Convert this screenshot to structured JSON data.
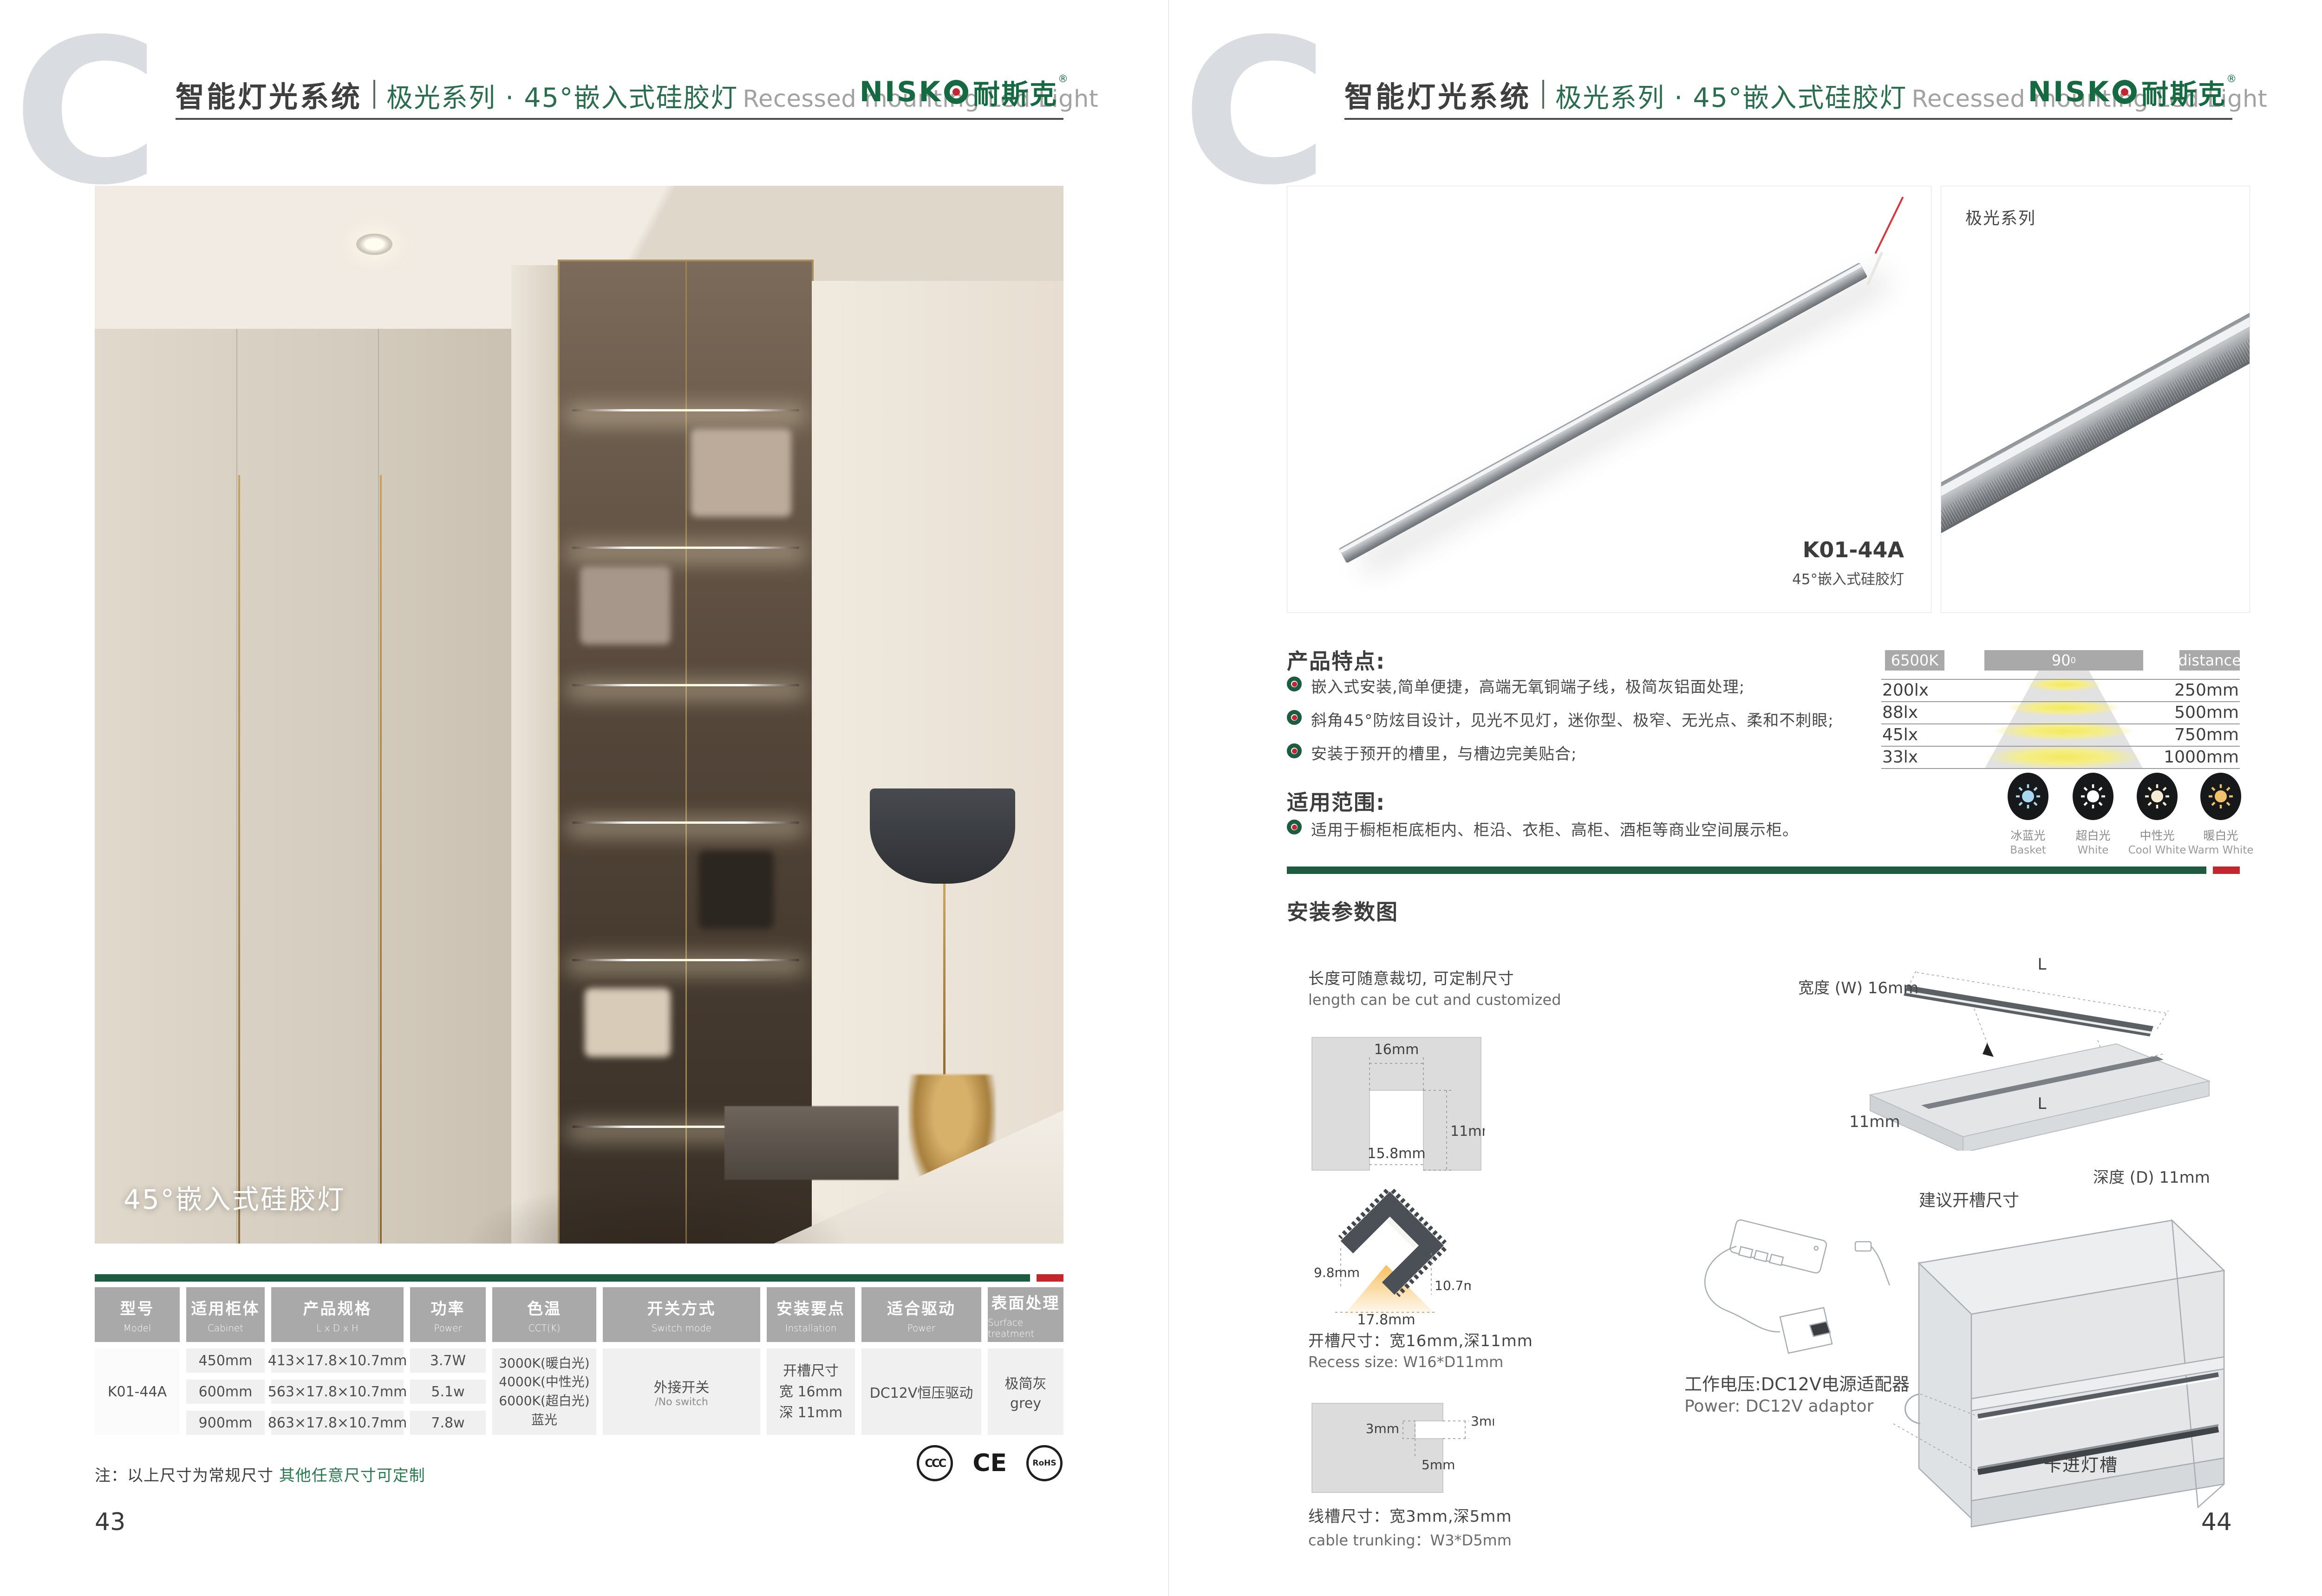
{
  "header": {
    "system": "智能灯光系统",
    "series": "极光系列 · 45°嵌入式硅胶灯",
    "subtitle_en": "Recessed mounting Led Light",
    "logo": {
      "latin": "NISK",
      "cn": "耐斯克",
      "reg": "®"
    }
  },
  "colors": {
    "green": "#1d5c40",
    "red": "#c1272d",
    "table_header_gray": "#a9a9a9"
  },
  "left_page": {
    "photo_caption": "45°嵌入式硅胶灯",
    "spec_table": {
      "headers": [
        {
          "zh": "型号",
          "en": "Model"
        },
        {
          "zh": "适用柜体",
          "en": "Cabinet"
        },
        {
          "zh": "产品规格",
          "en": "L x D x H"
        },
        {
          "zh": "功率",
          "en": "Power"
        },
        {
          "zh": "色温",
          "en": "CCT(K)"
        },
        {
          "zh": "开关方式",
          "en": "Switch mode"
        },
        {
          "zh": "安装要点",
          "en": "Installation"
        },
        {
          "zh": "适合驱动",
          "en": "Power"
        },
        {
          "zh": "表面处理",
          "en": "Surface treatment"
        }
      ],
      "model": "K01-44A",
      "rows": [
        {
          "cabinet": "450mm",
          "spec": "413×17.8×10.7mm",
          "power": "3.7W"
        },
        {
          "cabinet": "600mm",
          "spec": "563×17.8×10.7mm",
          "power": "5.1w"
        },
        {
          "cabinet": "900mm",
          "spec": "863×17.8×10.7mm",
          "power": "7.8w"
        }
      ],
      "cct_lines": "3000K(暖白光)\n4000K(中性光)\n6000K(超白光)\n蓝光",
      "switch_zh": "外接开关",
      "switch_en": "/No switch",
      "install_lines": "开槽尺寸\n宽 16mm\n深 11mm",
      "driver": "DC12V恒压驱动",
      "surface_zh": "极简灰",
      "surface_en": "grey"
    },
    "note_prefix": "注：以上尺寸为常规尺寸 ",
    "note_highlight": "其他任意尺寸可定制",
    "certs": [
      "CCC",
      "CE",
      "RoHS"
    ],
    "page_number": "43"
  },
  "right_page": {
    "gallery": {
      "model": "K01-44A",
      "model_sub": "45°嵌入式硅胶灯",
      "series_tag": "极光系列"
    },
    "features": {
      "title": "产品特点:",
      "items": [
        "嵌入式安装,简单便捷，高端无氧铜端子线，极简灰铝面处理;",
        "斜角45°防炫目设计，见光不见灯，迷你型、极窄、无光点、柔和不刺眼;",
        "安装于预开的槽里，与槽边完美贴合;"
      ]
    },
    "scope": {
      "title": "适用范围:",
      "items": [
        "适用于橱柜柜底柜内、柜沿、衣柜、高柜、酒柜等商业空间展示柜。"
      ]
    },
    "light_chart": {
      "kelvin": "6500K",
      "angle": "90",
      "angle_sup": "0",
      "distance_label": "distance",
      "rows": [
        {
          "lux": "200lx",
          "distance": "250mm"
        },
        {
          "lux": "88lx",
          "distance": "500mm"
        },
        {
          "lux": "45lx",
          "distance": "750mm"
        },
        {
          "lux": "33lx",
          "distance": "1000mm"
        }
      ]
    },
    "swatches": [
      {
        "zh": "冰蓝光",
        "en": "Basket",
        "color": "#a8d8f0"
      },
      {
        "zh": "超白光",
        "en": "White",
        "color": "#ffffff"
      },
      {
        "zh": "中性光",
        "en": "Cool White",
        "color": "#f6ecd4"
      },
      {
        "zh": "暖白光",
        "en": "Warm White",
        "color": "#f0c16a"
      }
    ],
    "install": {
      "title": "安装参数图",
      "cut_note_zh": "长度可随意裁切, 可定制尺寸",
      "cut_note_en": "length can be cut and customized",
      "recess": {
        "width_top": "16mm",
        "depth": "11mm",
        "width_inner": "15.8mm"
      },
      "profile": {
        "h_left": "9.8mm",
        "h_right": "10.7mm",
        "w_bottom": "17.8mm"
      },
      "recess_text_zh": "开槽尺寸：宽16mm,深11mm",
      "recess_text_en": "Recess size: W16*D11mm",
      "trunk": {
        "t_right": "3mm",
        "t_left": "3mm",
        "t_bottom": "5mm"
      },
      "trunk_text_zh": "线槽尺寸：宽3mm,深5mm",
      "trunk_text_en": "cable trunking：W3*D5mm",
      "panel": {
        "width_label": "宽度 (W) 16mm",
        "depth_label": "深度 (D) 11mm",
        "edge_label": "11mm",
        "length_label": "L",
        "caption": "建议开槽尺寸"
      },
      "power_zh": "工作电压:DC12V电源适配器",
      "power_en": "Power: DC12V adaptor",
      "cabinet_label": "卡进灯槽"
    },
    "page_number": "44"
  },
  "chart_data": {
    "type": "table",
    "title": "6500K 90° light distribution",
    "columns": [
      "illuminance",
      "distance"
    ],
    "rows": [
      [
        "200lx",
        "250mm"
      ],
      [
        "88lx",
        "500mm"
      ],
      [
        "45lx",
        "750mm"
      ],
      [
        "33lx",
        "1000mm"
      ]
    ]
  }
}
